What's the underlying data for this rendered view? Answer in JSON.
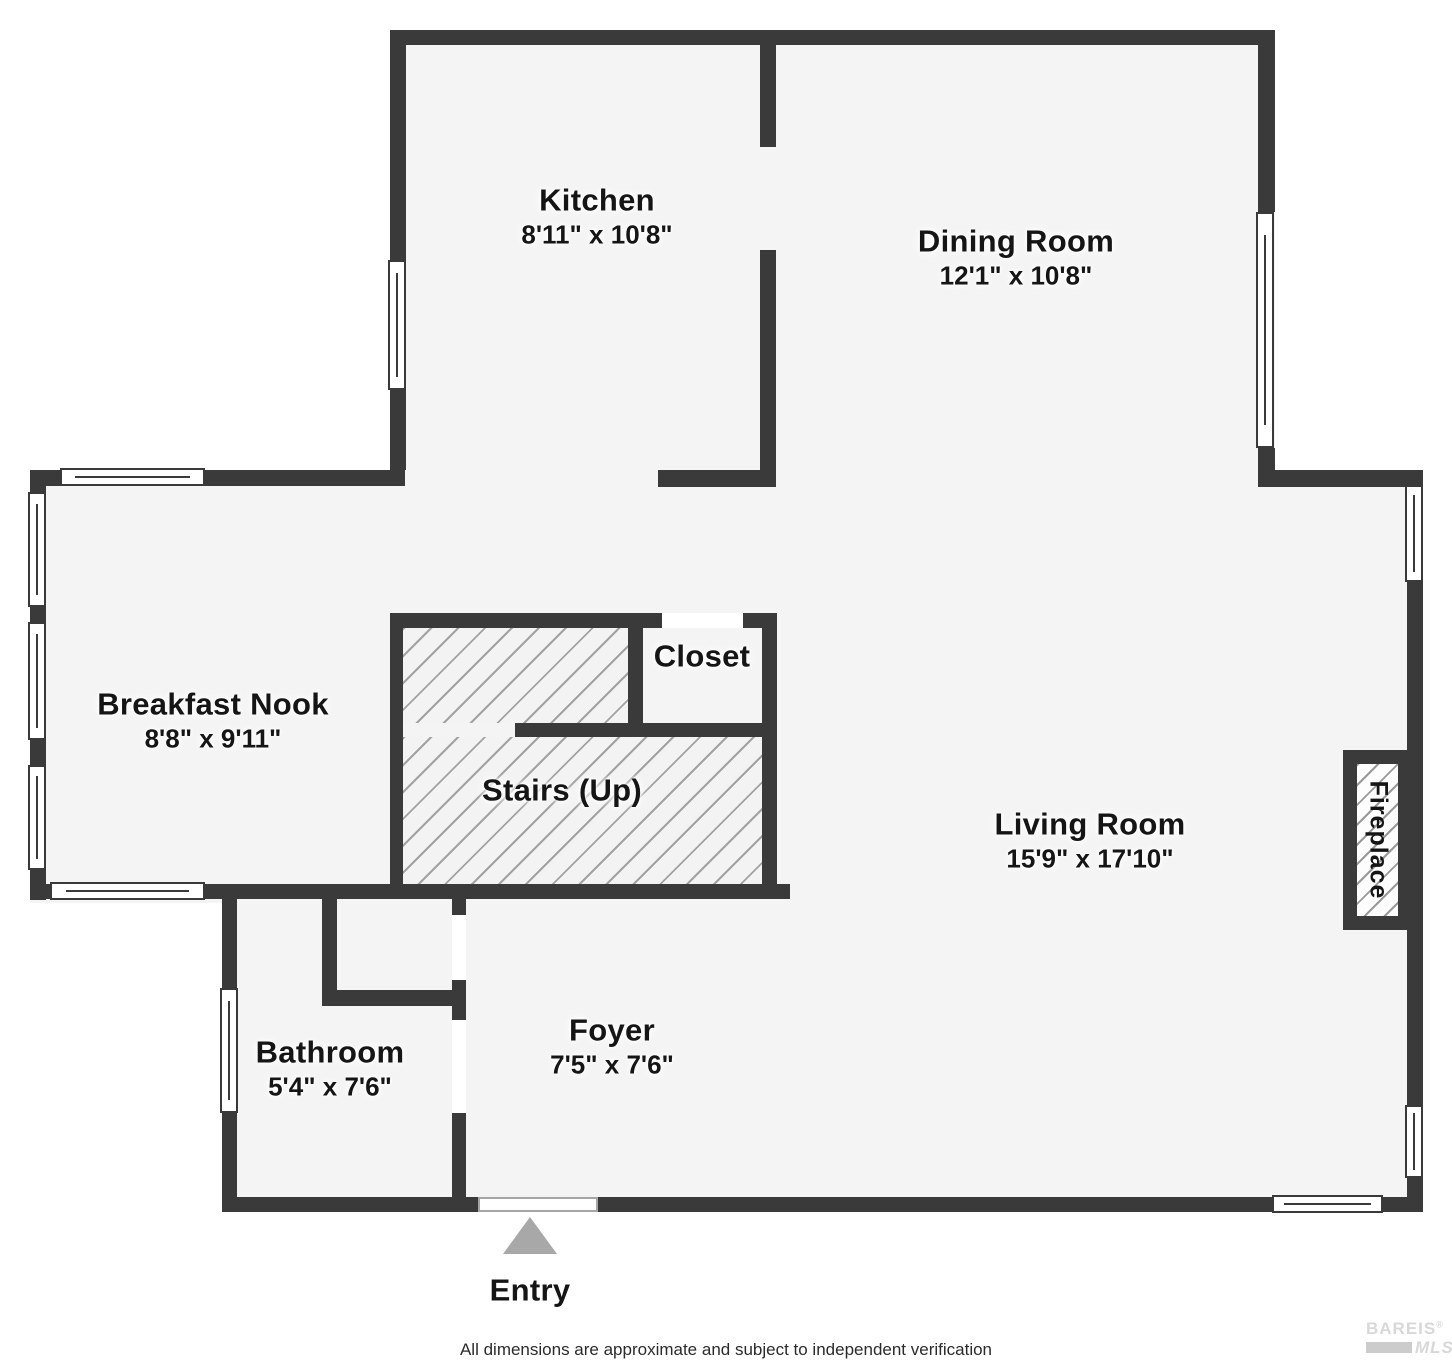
{
  "colors": {
    "wall": "#3a3a3a",
    "floor": "#f4f4f4",
    "hatch_line": "#a2a2a2",
    "window_fill": "#ffffff",
    "entry_arrow": "#a8a8a8",
    "label_text": "#151515",
    "logo_gray": "#d8d8d8"
  },
  "rooms": {
    "kitchen": {
      "label": "Kitchen",
      "dims": "8'11\" x 10'8\""
    },
    "dining": {
      "label": "Dining Room",
      "dims": "12'1\" x 10'8\""
    },
    "nook": {
      "label": "Breakfast Nook",
      "dims": "8'8\" x 9'11\""
    },
    "closet": {
      "label": "Closet"
    },
    "stairs": {
      "label": "Stairs (Up)"
    },
    "living": {
      "label": "Living Room",
      "dims": "15'9\" x 17'10\""
    },
    "fireplace": {
      "label": "Fireplace"
    },
    "bathroom": {
      "label": "Bathroom",
      "dims": "5'4\" x 7'6\""
    },
    "foyer": {
      "label": "Foyer",
      "dims": "7'5\" x 7'6\""
    }
  },
  "entry": {
    "label": "Entry"
  },
  "footer": {
    "disclaimer": "All dimensions are approximate and subject to independent verification"
  },
  "logo": {
    "name": "BAREIS",
    "registered": "®",
    "sub": "MLS"
  }
}
